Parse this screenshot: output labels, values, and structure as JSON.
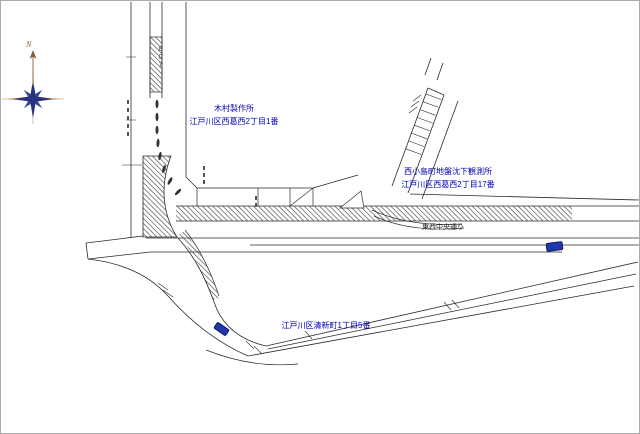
{
  "canvas": {
    "width": 640,
    "height": 434,
    "background": "#ffffff",
    "border_color": "#aaaaaa"
  },
  "colors": {
    "line": "#2a2a2a",
    "hatch": "#3a3a3a",
    "label_blue": "#0000b4",
    "road_text": "#222222",
    "vehicle_marker_blue": "#2038a8",
    "compass_navy": "#28337e",
    "compass_navy_light": "#3a4796",
    "compass_tan": "#b5854f",
    "north_brown": "#8a5a33"
  },
  "labels": {
    "landmark_kimura": {
      "line1": "木村製作所",
      "line2": "江戸川区西葛西2丁目1番"
    },
    "landmark_observatory": {
      "line1": "西小島町地盤沈下観測所",
      "line2": "江戸川区西葛西2丁目17番"
    },
    "landmark_seishincho": {
      "line1": "江戸川区清新町1丁目5番"
    },
    "road_name": "東西中央通り",
    "route_number": "807",
    "compass_north": "N"
  }
}
